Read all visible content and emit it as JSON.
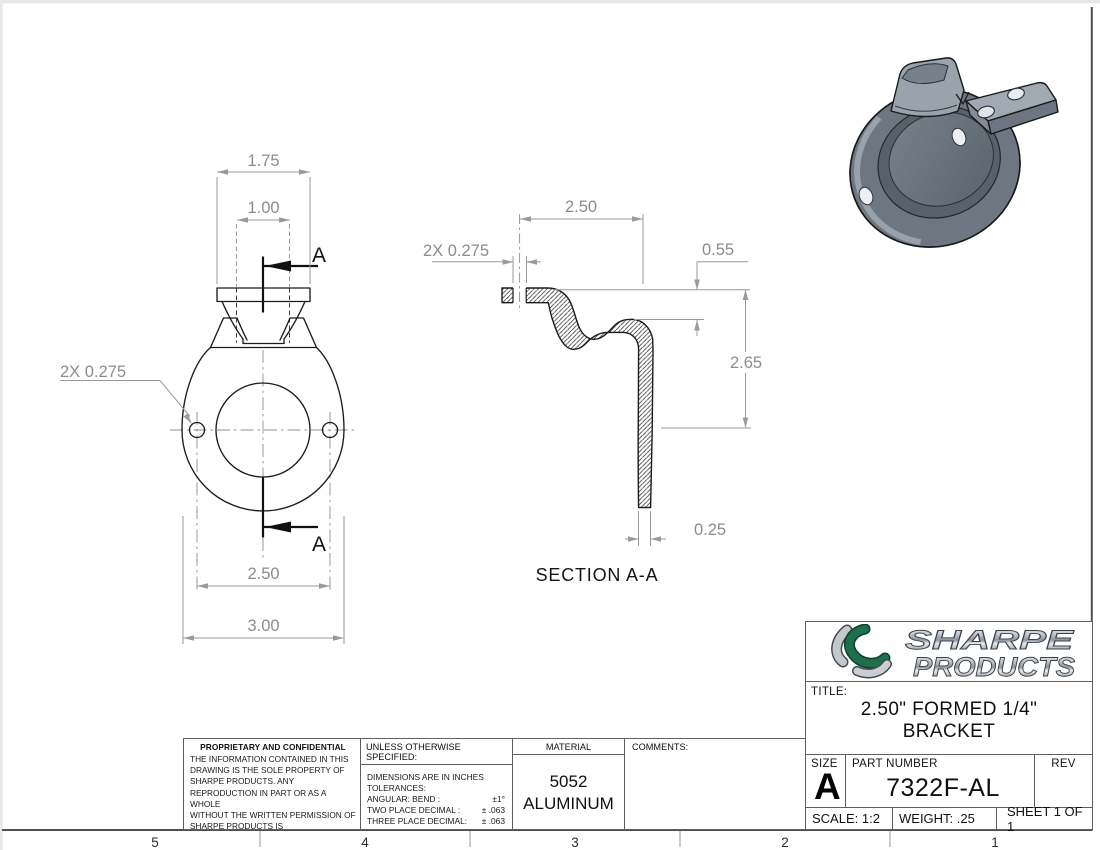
{
  "sheet": {
    "zone_numbers": [
      "5",
      "4",
      "3",
      "2",
      "1"
    ]
  },
  "front_view": {
    "dim_tab_width": "1.75",
    "dim_tab_holes": "1.00",
    "dim_flange_holes": "2X 0.275",
    "dim_bolt_span": "2.50",
    "dim_overall_width": "3.00",
    "section_arrow_top": "A",
    "section_arrow_bottom": "A"
  },
  "section_view": {
    "dim_depth": "2.50",
    "dim_hole": "2X 0.275",
    "dim_offset": "0.55",
    "dim_height": "2.65",
    "dim_thickness": "0.25",
    "caption": "SECTION A-A"
  },
  "title_block": {
    "logo_line1": "SHARPE",
    "logo_line2": "PRODUCTS",
    "title_label": "TITLE:",
    "title_line1": "2.50\" FORMED 1/4\"",
    "title_line2": "BRACKET",
    "size_label": "SIZE",
    "size_value": "A",
    "part_number_label": "PART NUMBER",
    "part_number": "7322F-AL",
    "rev_label": "REV",
    "scale": "SCALE: 1:2",
    "weight": "WEIGHT: .25",
    "sheet": "SHEET 1 OF 1"
  },
  "notes": {
    "proprietary": {
      "title": "PROPRIETARY AND CONFIDENTIAL",
      "lines": [
        "THE INFORMATION CONTAINED IN THIS",
        "DRAWING IS THE SOLE PROPERTY OF",
        "SHARPE PRODUCTS.  ANY",
        "REPRODUCTION IN PART OR AS A WHOLE",
        "WITHOUT THE WRITTEN PERMISSION OF",
        "SHARPE PRODUCTS IS",
        "PROHIBITED."
      ]
    },
    "tolerances": {
      "header": "UNLESS OTHERWISE SPECIFIED:",
      "line1": "DIMENSIONS ARE IN INCHES",
      "line2": "TOLERANCES:",
      "rows": [
        {
          "label": "ANGULAR: BEND :",
          "value": "±1°"
        },
        {
          "label": "TWO PLACE DECIMAL :",
          "value": "± .063"
        },
        {
          "label": "THREE PLACE DECIMAL:",
          "value": "± .063"
        }
      ]
    },
    "material": {
      "label": "MATERIAL",
      "line1": "5052",
      "line2": "ALUMINUM"
    },
    "comments_label": "COMMENTS:"
  },
  "colors": {
    "line_black": "#1c1c1c",
    "dim_gray": "#8f8f8f",
    "logo_green": "#1e6f4e",
    "logo_silver": "#c3c8cd",
    "part_face": "#6e7781",
    "part_recess": "#586069",
    "part_light": "#9da5ae"
  }
}
